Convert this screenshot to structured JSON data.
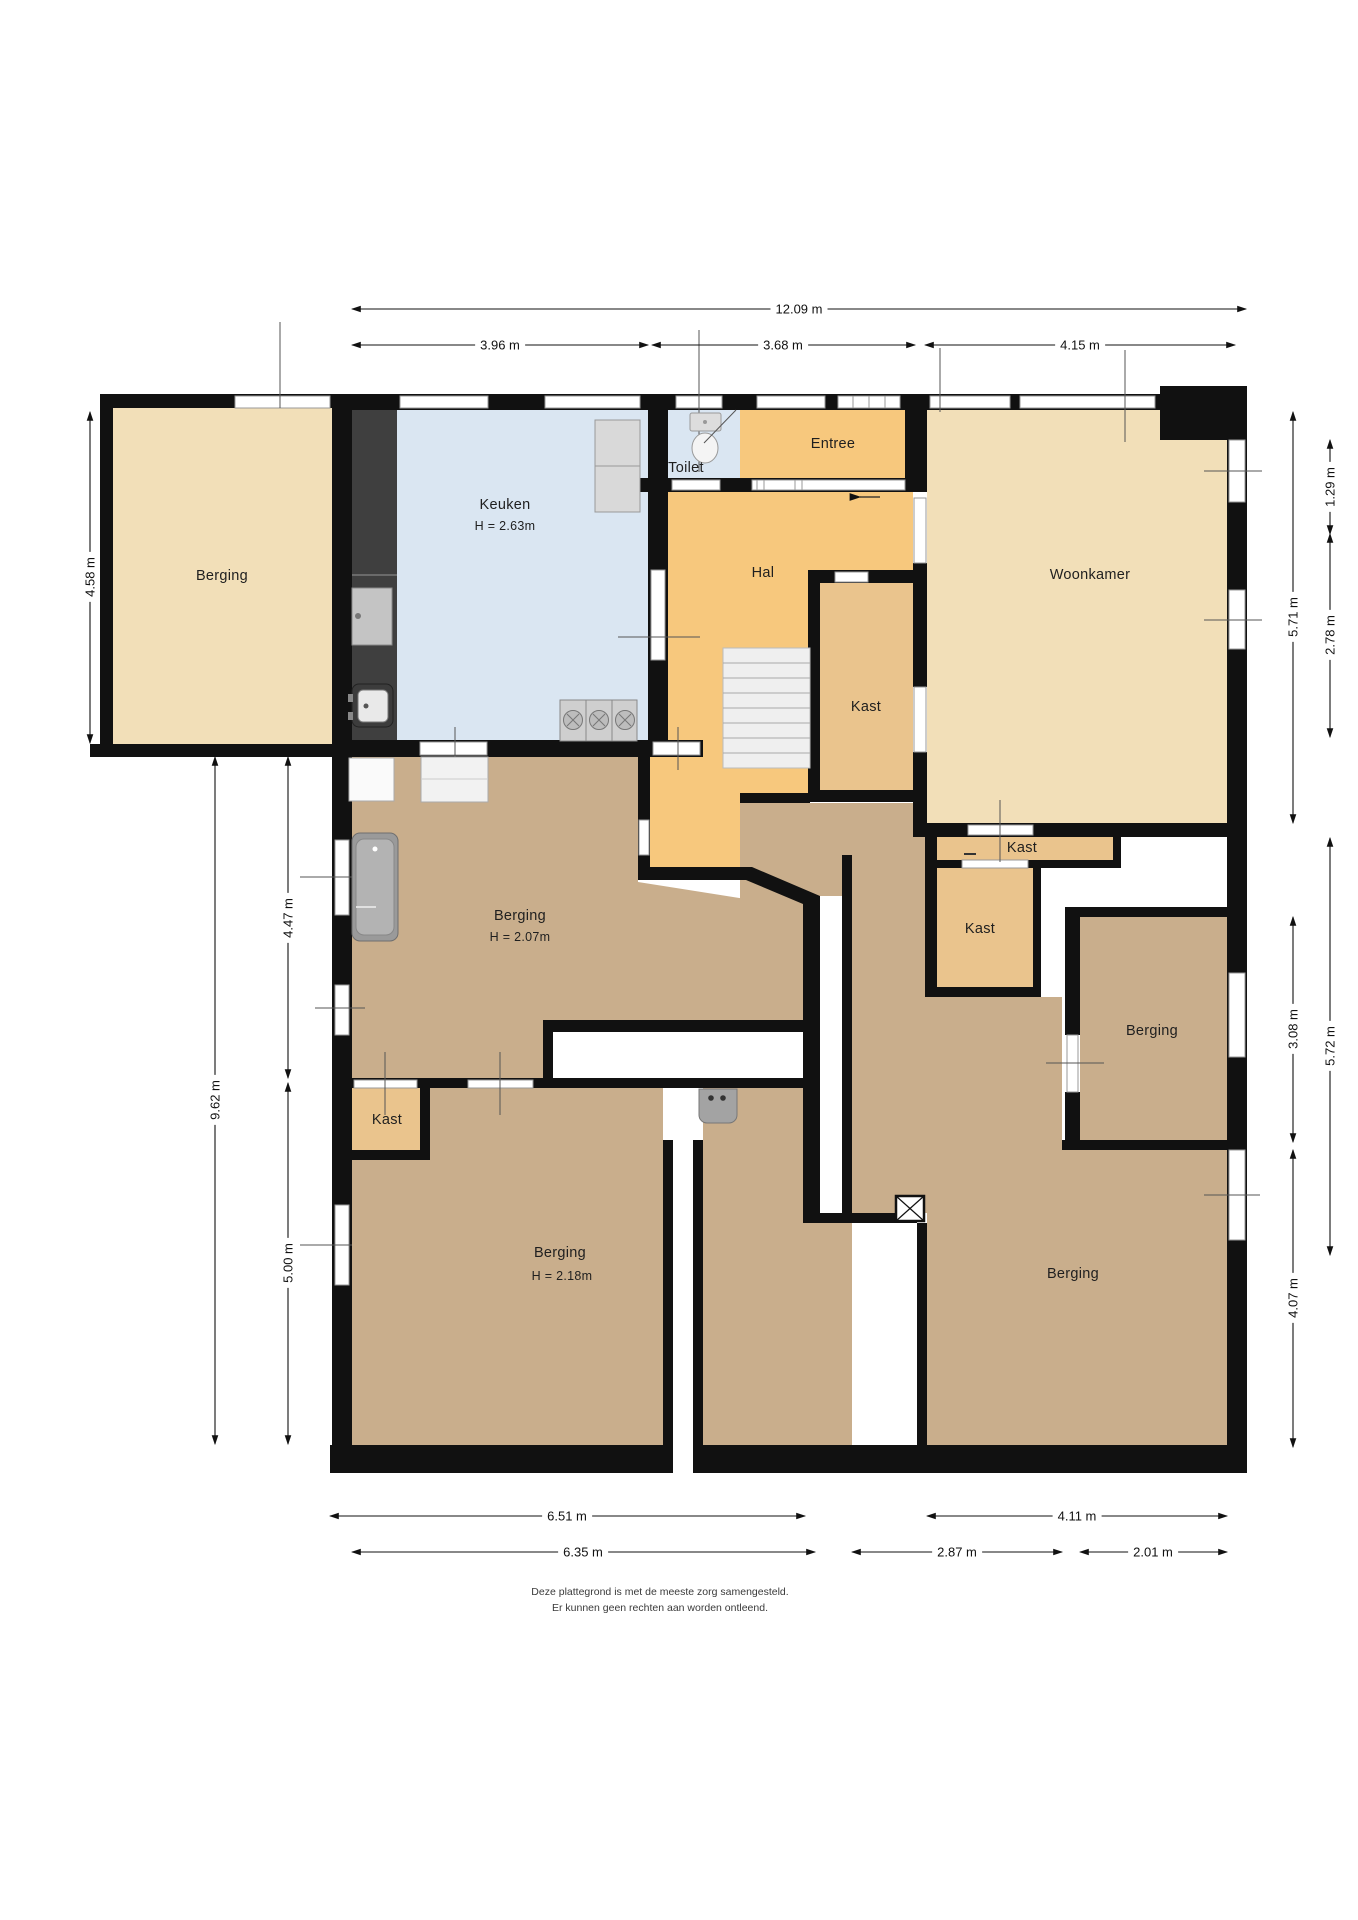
{
  "rooms": {
    "berging_annex": {
      "label": "Berging"
    },
    "keuken": {
      "label": "Keuken",
      "height": "H = 2.63m"
    },
    "toilet": {
      "label": "Toilet"
    },
    "entree": {
      "label": "Entree"
    },
    "hal": {
      "label": "Hal"
    },
    "woonkamer": {
      "label": "Woonkamer"
    },
    "kast_center": {
      "label": "Kast"
    },
    "kast_strip": {
      "label": "Kast"
    },
    "kast_mid": {
      "label": "Kast"
    },
    "berging_middle": {
      "label": "Berging",
      "height": "H = 2.07m"
    },
    "berging_right": {
      "label": "Berging"
    },
    "berging_bottom_left": {
      "label": "Berging",
      "height": "H = 2.18m"
    },
    "kast_bottom_left": {
      "label": "Kast"
    },
    "berging_bottom_right": {
      "label": "Berging"
    }
  },
  "dims": {
    "top": [
      "12.09 m",
      "3.96 m",
      "3.68 m",
      "4.15 m"
    ],
    "left": [
      "4.58 m",
      "9.62 m",
      "4.47 m",
      "5.00 m"
    ],
    "right": [
      "5.71 m",
      "1.29 m",
      "2.78 m",
      "5.72 m",
      "3.08 m",
      "4.07 m"
    ],
    "bottom": [
      "6.51 m",
      "6.35 m",
      "2.87 m",
      "4.11 m",
      "2.01 m"
    ]
  },
  "disclaimer": {
    "line1": "Deze plattegrond is met de meeste zorg samengesteld.",
    "line2": "Er kunnen geen rechten aan worden ontleend."
  },
  "colors": {
    "wall": "#111111",
    "room_tan": "#f2dfb8",
    "room_orange": "#f7c87d",
    "room_brown": "#c9ae8c",
    "room_kast": "#eac48d",
    "room_blue": "#dae6f2",
    "counter_dark": "#3f3f3f",
    "window_line": "#999999"
  }
}
